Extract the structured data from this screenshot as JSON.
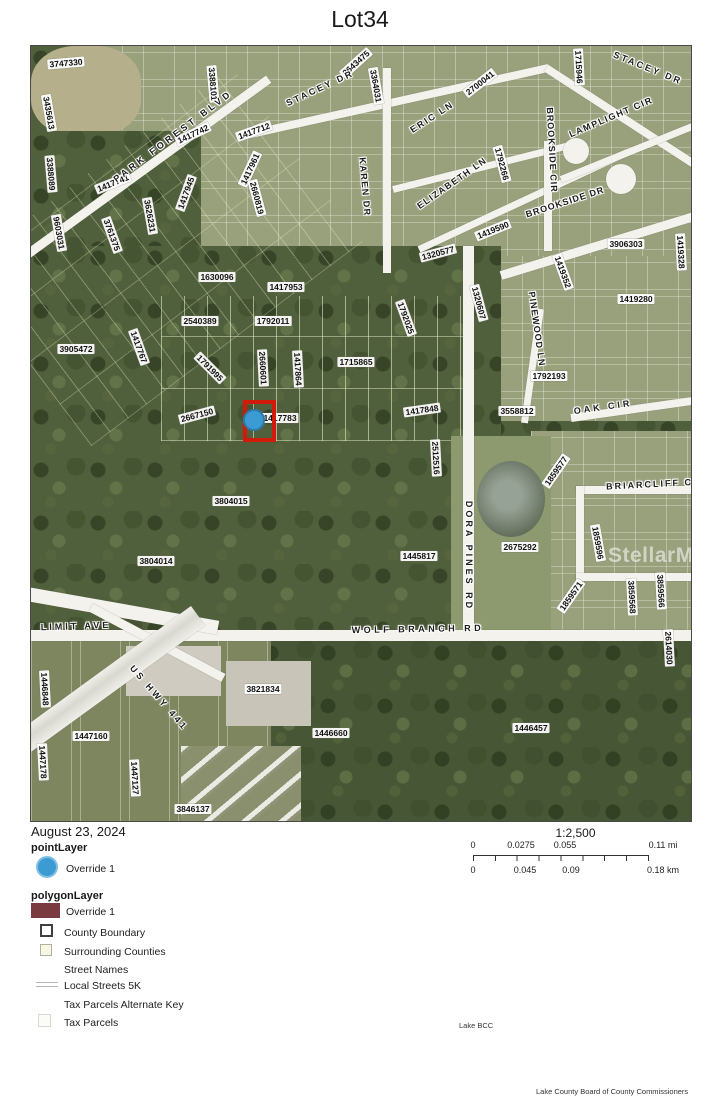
{
  "title": "Lot34",
  "colors": {
    "marker_red": "#d11a0a",
    "point_blue": "#3d9bd3",
    "polygon_maroon": "#7a3b40"
  },
  "map": {
    "watermark": "StellarMLS",
    "marker": {
      "square": {
        "x": 212,
        "y": 354,
        "w": 25,
        "h": 34
      },
      "dot": {
        "cx": 223,
        "cy": 374,
        "r": 11
      }
    },
    "parcel_labels": [
      {
        "t": "3747330",
        "x": 35,
        "y": 17,
        "r": -5
      },
      {
        "t": "3435613",
        "x": 18,
        "y": 67,
        "r": 80
      },
      {
        "t": "3388101",
        "x": 182,
        "y": 38,
        "r": 85
      },
      {
        "t": "1417742",
        "x": 162,
        "y": 88,
        "r": -25
      },
      {
        "t": "1417712",
        "x": 223,
        "y": 85,
        "r": -20
      },
      {
        "t": "3643475",
        "x": 325,
        "y": 17,
        "r": -42
      },
      {
        "t": "3364031",
        "x": 345,
        "y": 40,
        "r": 80
      },
      {
        "t": "2700041",
        "x": 449,
        "y": 37,
        "r": -38
      },
      {
        "t": "1715946",
        "x": 548,
        "y": 21,
        "r": 87
      },
      {
        "t": "3388089",
        "x": 20,
        "y": 128,
        "r": 85
      },
      {
        "t": "1417741",
        "x": 82,
        "y": 137,
        "r": -22
      },
      {
        "t": "1417961",
        "x": 219,
        "y": 123,
        "r": -65
      },
      {
        "t": "1417945",
        "x": 155,
        "y": 147,
        "r": -70
      },
      {
        "t": "2660819",
        "x": 226,
        "y": 152,
        "r": 75
      },
      {
        "t": "1792266",
        "x": 471,
        "y": 118,
        "r": 75
      },
      {
        "t": "9603031",
        "x": 28,
        "y": 187,
        "r": 80
      },
      {
        "t": "3626231",
        "x": 119,
        "y": 170,
        "r": 80
      },
      {
        "t": "3761375",
        "x": 81,
        "y": 189,
        "r": 70
      },
      {
        "t": "1630096",
        "x": 186,
        "y": 231,
        "r": 0
      },
      {
        "t": "1417953",
        "x": 255,
        "y": 241,
        "r": 0
      },
      {
        "t": "1320577",
        "x": 407,
        "y": 207,
        "r": -15
      },
      {
        "t": "1419590",
        "x": 462,
        "y": 184,
        "r": -22
      },
      {
        "t": "3906303",
        "x": 595,
        "y": 198,
        "r": 0
      },
      {
        "t": "1419328",
        "x": 650,
        "y": 206,
        "r": 87
      },
      {
        "t": "1419352",
        "x": 532,
        "y": 226,
        "r": 70
      },
      {
        "t": "1419280",
        "x": 605,
        "y": 253,
        "r": 0
      },
      {
        "t": "2540389",
        "x": 169,
        "y": 275,
        "r": 0
      },
      {
        "t": "1792011",
        "x": 242,
        "y": 275,
        "r": 0
      },
      {
        "t": "3905472",
        "x": 45,
        "y": 303,
        "r": 0
      },
      {
        "t": "1417767",
        "x": 108,
        "y": 301,
        "r": 70
      },
      {
        "t": "1791995",
        "x": 179,
        "y": 322,
        "r": 45
      },
      {
        "t": "2660601",
        "x": 232,
        "y": 322,
        "r": 87
      },
      {
        "t": "1417864",
        "x": 267,
        "y": 323,
        "r": 87
      },
      {
        "t": "1715865",
        "x": 325,
        "y": 316,
        "r": 0
      },
      {
        "t": "1320607",
        "x": 448,
        "y": 257,
        "r": 75
      },
      {
        "t": "1792025",
        "x": 375,
        "y": 272,
        "r": 70
      },
      {
        "t": "1792193",
        "x": 518,
        "y": 330,
        "r": 0
      },
      {
        "t": "2667150",
        "x": 166,
        "y": 369,
        "r": -15
      },
      {
        "t": "1417783",
        "x": 249,
        "y": 372,
        "r": 0
      },
      {
        "t": "1417848",
        "x": 391,
        "y": 364,
        "r": -8
      },
      {
        "t": "3558812",
        "x": 486,
        "y": 365,
        "r": 0
      },
      {
        "t": "2512516",
        "x": 405,
        "y": 412,
        "r": 87
      },
      {
        "t": "1859577",
        "x": 525,
        "y": 425,
        "r": -55
      },
      {
        "t": "3804015",
        "x": 200,
        "y": 455,
        "r": 0
      },
      {
        "t": "1445817",
        "x": 388,
        "y": 510,
        "r": 0
      },
      {
        "t": "2675292",
        "x": 489,
        "y": 501,
        "r": 0
      },
      {
        "t": "1859596",
        "x": 567,
        "y": 497,
        "r": 80
      },
      {
        "t": "3804014",
        "x": 125,
        "y": 515,
        "r": 0
      },
      {
        "t": "1859571",
        "x": 540,
        "y": 550,
        "r": -55
      },
      {
        "t": "3859568",
        "x": 601,
        "y": 551,
        "r": 87
      },
      {
        "t": "3859566",
        "x": 630,
        "y": 545,
        "r": 87
      },
      {
        "t": "2614030",
        "x": 638,
        "y": 602,
        "r": 87
      },
      {
        "t": "1446848",
        "x": 14,
        "y": 643,
        "r": 87
      },
      {
        "t": "3821834",
        "x": 232,
        "y": 643,
        "r": 0
      },
      {
        "t": "1446660",
        "x": 300,
        "y": 687,
        "r": 0
      },
      {
        "t": "1446457",
        "x": 500,
        "y": 682,
        "r": 0
      },
      {
        "t": "1447160",
        "x": 60,
        "y": 690,
        "r": 0
      },
      {
        "t": "1447178",
        "x": 12,
        "y": 716,
        "r": 87
      },
      {
        "t": "1447127",
        "x": 104,
        "y": 732,
        "r": 87
      },
      {
        "t": "3846137",
        "x": 162,
        "y": 763,
        "r": 0
      }
    ],
    "street_labels": [
      {
        "t": "PARK FOREST BLVD",
        "x": 142,
        "y": 90,
        "r": -37,
        "sp": 3.5
      },
      {
        "t": "STACEY DR",
        "x": 289,
        "y": 42,
        "r": -25,
        "sp": 2.5
      },
      {
        "t": "STACEY DR",
        "x": 617,
        "y": 22,
        "r": 22,
        "sp": 2.5
      },
      {
        "t": "ERIC LN",
        "x": 401,
        "y": 71,
        "r": -33,
        "sp": 2
      },
      {
        "t": "LAMPLIGHT CIR",
        "x": 580,
        "y": 71,
        "r": -23,
        "sp": 1.5
      },
      {
        "t": "KAREN DR",
        "x": 334,
        "y": 141,
        "r": 85,
        "sp": 1.5
      },
      {
        "t": "ELIZABETH LN",
        "x": 421,
        "y": 137,
        "r": -35,
        "sp": 1.5
      },
      {
        "t": "BROOKSIDE CIR",
        "x": 521,
        "y": 104,
        "r": 87,
        "sp": 1
      },
      {
        "t": "BROOKSIDE DR",
        "x": 534,
        "y": 156,
        "r": -18,
        "sp": 1
      },
      {
        "t": "PINEWOOD LN",
        "x": 506,
        "y": 283,
        "r": 82,
        "sp": 1
      },
      {
        "t": "OAK CIR",
        "x": 572,
        "y": 361,
        "r": -8,
        "sp": 3
      },
      {
        "t": "BRIARCLIFF CIR",
        "x": 625,
        "y": 438,
        "r": -3,
        "sp": 2
      },
      {
        "t": "DORA PINES RD",
        "x": 438,
        "y": 510,
        "r": 90,
        "sp": 3
      },
      {
        "t": "LIMIT AVE",
        "x": 45,
        "y": 580,
        "r": -2,
        "sp": 3
      },
      {
        "t": "WOLF BRANCH RD",
        "x": 387,
        "y": 583,
        "r": -1,
        "sp": 3.5
      },
      {
        "t": "US HWY 441",
        "x": 128,
        "y": 652,
        "r": 49,
        "sp": 3
      }
    ]
  },
  "legend": {
    "date": "August 23, 2024",
    "point_heading": "pointLayer",
    "point_item": "Override 1",
    "polygon_heading": "polygonLayer",
    "polygon_item": "Override 1",
    "county_boundary": "County Boundary",
    "surrounding_counties": "Surrounding Counties",
    "street_names": "Street Names",
    "local_streets": "Local Streets 5K",
    "tax_parcels_alt": "Tax Parcels Alternate Key",
    "tax_parcels": "Tax Parcels"
  },
  "scalebar": {
    "ratio": "1:2,500",
    "miles": {
      "ticks": [
        "0",
        "0.0275",
        "0.055",
        "0.11 mi"
      ]
    },
    "km": {
      "ticks": [
        "0",
        "0.045",
        "0.09",
        "0.18 km"
      ]
    }
  },
  "credits": {
    "small": "Lake BCC",
    "footer": "Lake County Board of County Commissioners"
  }
}
